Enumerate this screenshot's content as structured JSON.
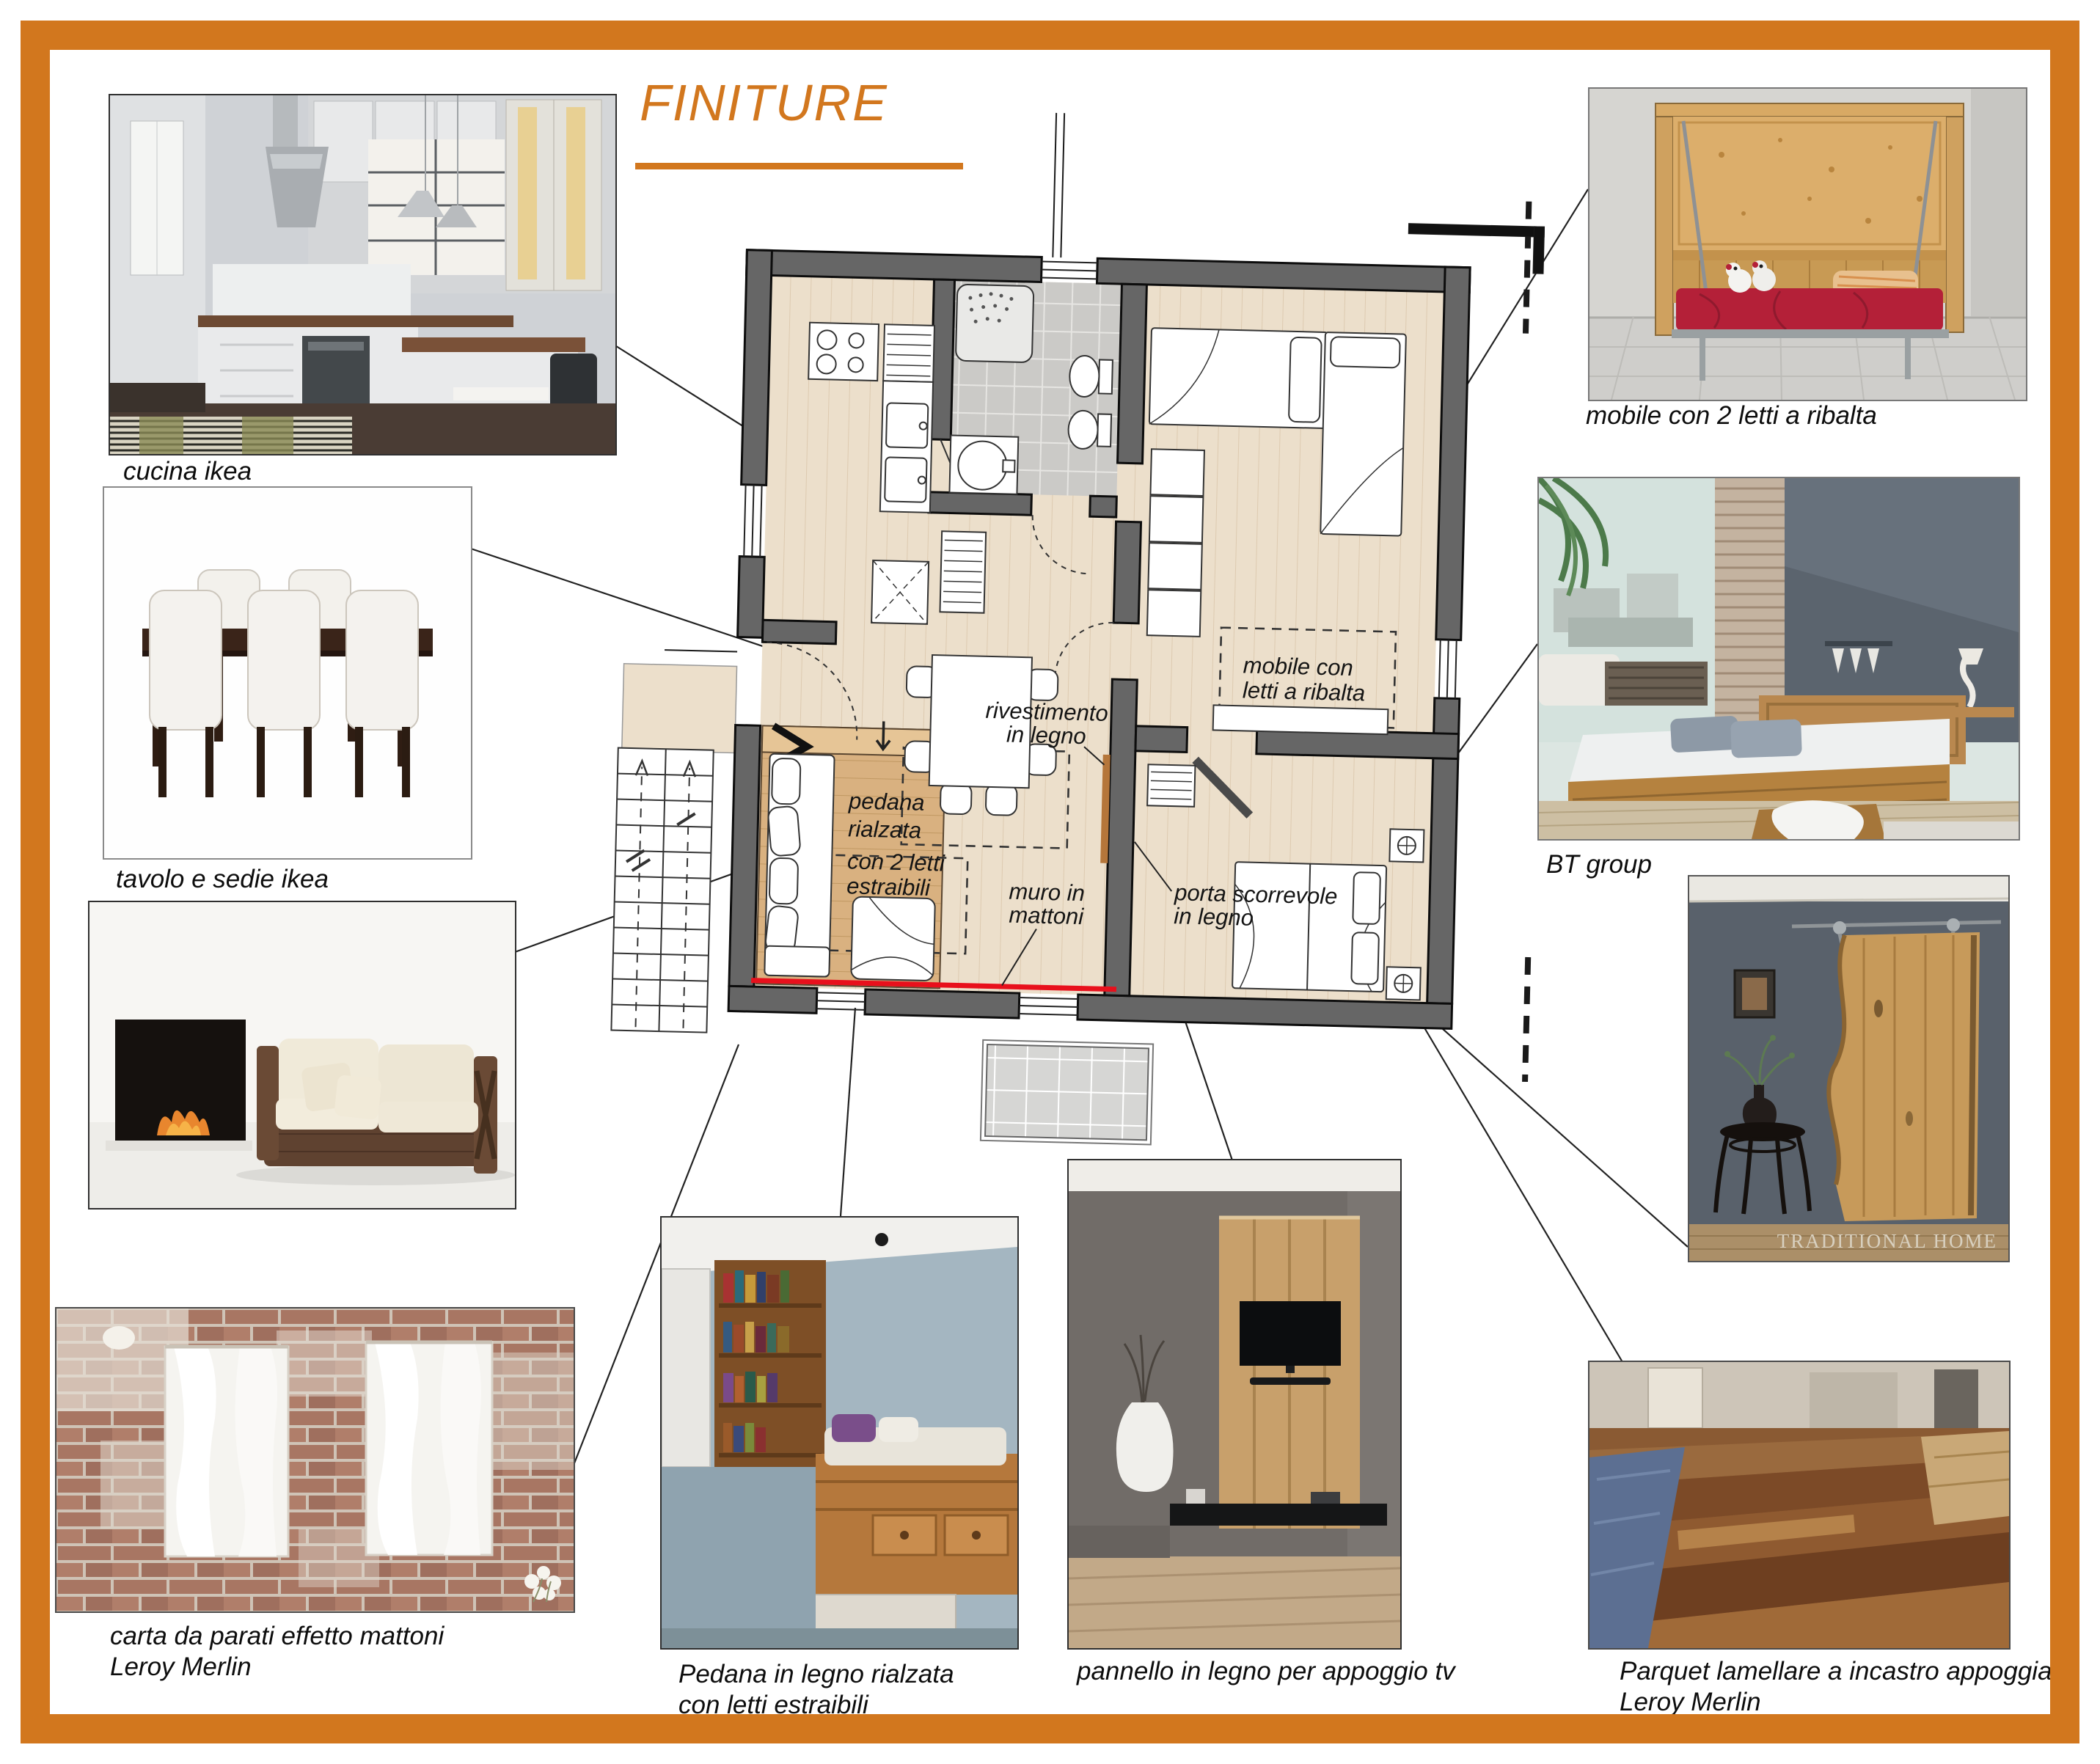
{
  "board": {
    "title": "FINITURE",
    "accent_color": "#d2771e",
    "wall_color": "#666666",
    "brick_wall_highlight_color": "#e8101c"
  },
  "plan": {
    "labels": {
      "mobile_line1": "mobile con",
      "mobile_line2": "letti a ribalta",
      "rivestimento_line1": "rivestimento",
      "rivestimento_line2": "in legno",
      "pedana_line1": "pedana",
      "pedana_line2": "rialzata",
      "pedana_line3": "con 2 letti",
      "pedana_line4": "estraibili",
      "muro_line1": "muro in",
      "muro_line2": "mattoni",
      "porta_line1": "porta scorrevole",
      "porta_line2": "in legno"
    }
  },
  "captions": {
    "cucina": "cucina ikea",
    "tavolo": "tavolo e sedie ikea",
    "carta_line1": "carta da parati effetto mattoni",
    "carta_line2": "Leroy Merlin",
    "pedana_line1": "Pedana in legno rialzata",
    "pedana_line2": "con letti estraibili",
    "pannello": "pannello in legno per appoggio tv",
    "parquet_line1": "Parquet lamellare a incastro appoggiato",
    "parquet_line2": "Leroy Merlin",
    "mobile": "mobile con 2 letti a ribalta",
    "bt": "BT group"
  },
  "photos": {
    "barn_watermark": "TRADITIONAL HOME"
  }
}
